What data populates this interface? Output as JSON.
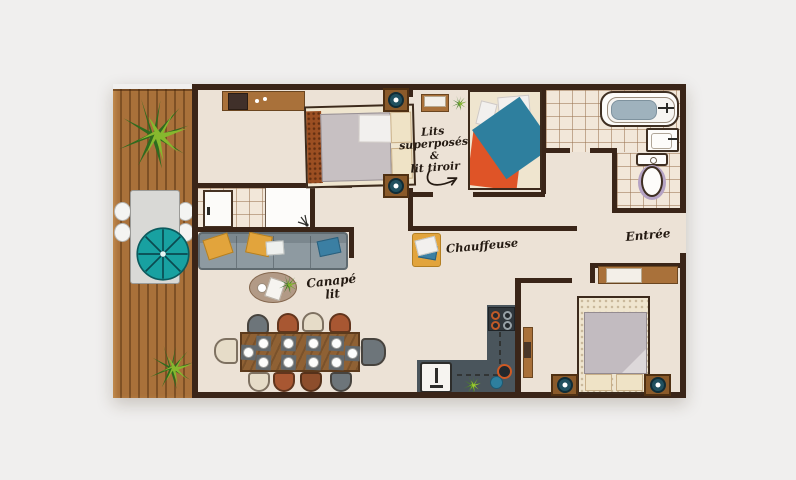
{
  "annotations": {
    "bunk": {
      "l1": "Lits",
      "l2": "superposés",
      "l3": "&",
      "l4": "lit tiroir"
    },
    "chauffeuse": "Chauffeuse",
    "sofa": {
      "l1": "Canapé",
      "l2": "lit"
    },
    "entrance": "Entrée"
  },
  "palette": {
    "background": "#f0efee",
    "floor": "#ece2d6",
    "wall": "#3a2518",
    "deck_wood": "#a9713a",
    "tile_line": "#9a7552",
    "teal_accent": "#18a1a1",
    "orange_accent": "#df5427",
    "blue_accent": "#2f7fa0",
    "yellow_accent": "#e2a43c",
    "kitchen_counter": "#4a555c",
    "mattress_gray": "#c5bec1",
    "linen_cream": "#efe3c6"
  },
  "icons": {
    "plant-icon": "green spiky plant burst",
    "parasol-icon": "teal umbrella circle with spokes",
    "lamp-icon": "dark teal circle with white dot",
    "shower-head-icon": "sparkle lines in shower corner",
    "arrow-icon": "curved annotation arrow"
  }
}
